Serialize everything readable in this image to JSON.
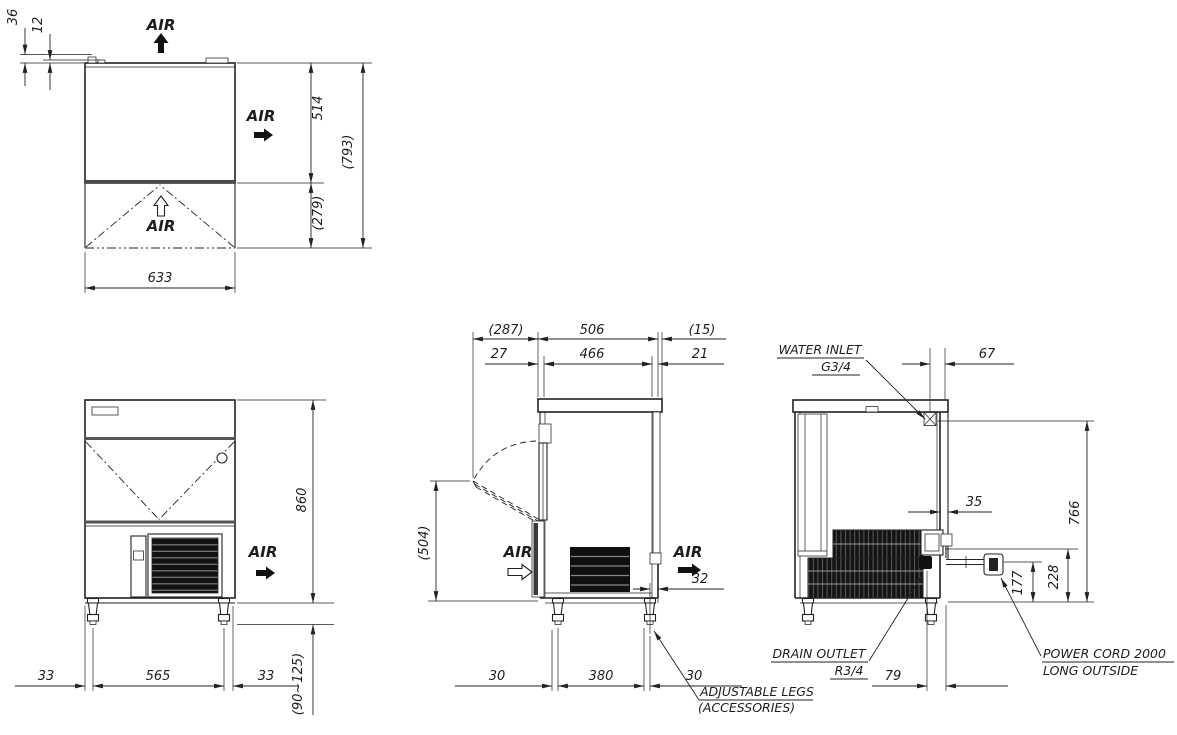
{
  "drawing": {
    "bg": "#ffffff",
    "ink": "#222222",
    "top_view": {
      "air_top": "AIR",
      "air_side": "AIR",
      "air_front": "AIR",
      "dim_36": "36",
      "dim_12": "12",
      "dim_514": "514",
      "dim_793": "(793)",
      "dim_279": "(279)",
      "dim_633": "633"
    },
    "front_view": {
      "air_out": "AIR",
      "dim_860": "860",
      "dim_33_left": "33",
      "dim_565": "565",
      "dim_33_right": "33",
      "dim_leg_height": "(90~125)"
    },
    "side_view": {
      "air_in": "AIR",
      "air_out": "AIR",
      "dim_287": "(287)",
      "dim_506": "506",
      "dim_15": "(15)",
      "dim_27": "27",
      "dim_466": "466",
      "dim_21": "21",
      "dim_504": "(504)",
      "dim_32": "32",
      "dim_30_front": "30",
      "dim_380": "380",
      "dim_30_rear": "30",
      "note_adjustable_legs_line1": "ADJUSTABLE LEGS",
      "note_adjustable_legs_line2": "(ACCESSORIES)"
    },
    "rear_view": {
      "dim_67": "67",
      "dim_35": "35",
      "dim_766": "766",
      "dim_177": "177",
      "dim_228": "228",
      "dim_79": "79",
      "note_water_inlet_line1": "WATER INLET",
      "note_water_inlet_line2": "G3/4",
      "note_drain_outlet_line1": "DRAIN OUTLET",
      "note_drain_outlet_line2": "R3/4",
      "note_power_cord_line1": "POWER CORD 2000",
      "note_power_cord_line2": "LONG OUTSIDE"
    }
  }
}
